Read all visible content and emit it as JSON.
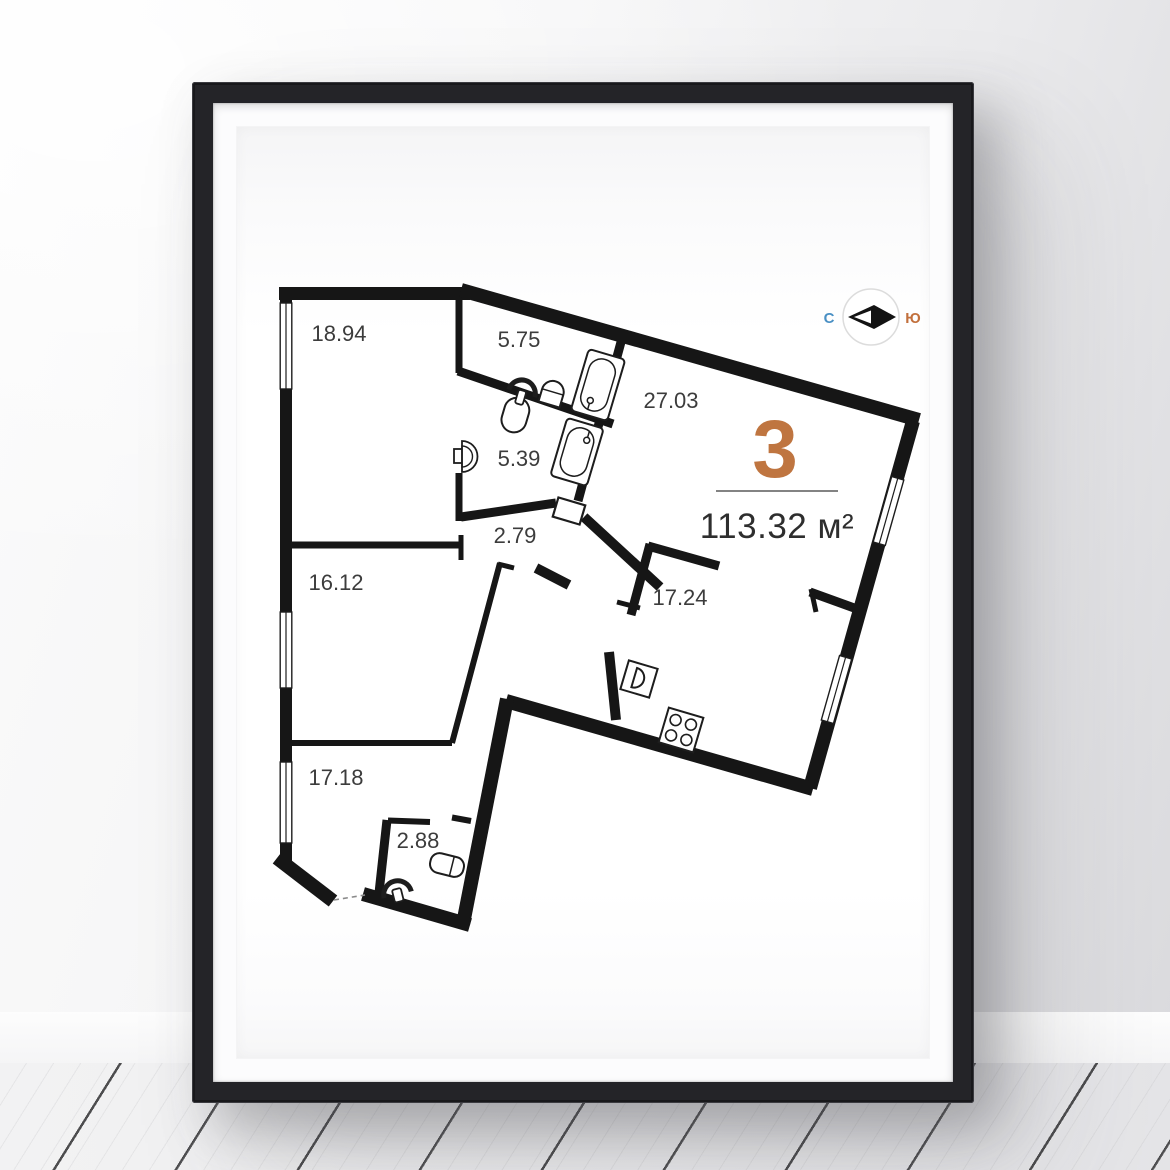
{
  "poster": {
    "unit_number": "3",
    "total_area": "113.32 м²",
    "compass": {
      "north_label": "С",
      "south_label": "Ю"
    },
    "room_areas": {
      "r1894": "18.94",
      "r575": "5.75",
      "r2703": "27.03",
      "r539": "5.39",
      "r279": "2.79",
      "r1612": "16.12",
      "r1724": "17.24",
      "r1718": "17.18",
      "r288": "2.88"
    },
    "icons": {
      "compass": "compass-icon",
      "toilet": "toilet-icon",
      "bathtub": "bathtub-icon",
      "sink": "sink-icon",
      "stove": "stove-icon",
      "window": "window-icon"
    },
    "colors": {
      "accent_orange": "#bf7540",
      "compass_north_blue": "#4a90c4",
      "compass_south_orange": "#c2703d",
      "wall_black": "#161616",
      "frame_black": "#242428",
      "label_gray": "#3c3c3c"
    }
  }
}
